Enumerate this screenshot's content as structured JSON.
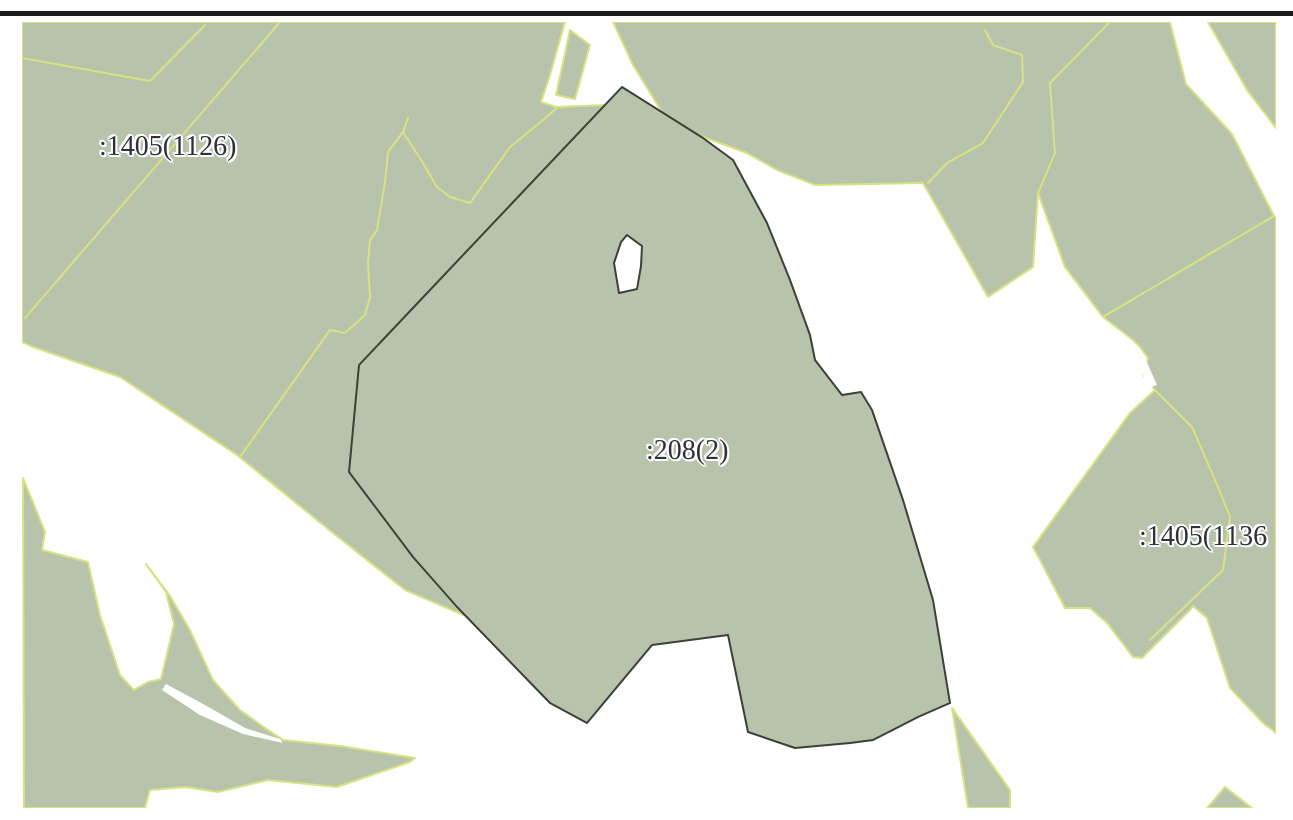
{
  "map": {
    "labels": [
      {
        "text": ":1405(1126)"
      },
      {
        "text": ":208(2)"
      },
      {
        "text": ":1405(1136"
      }
    ],
    "colors": {
      "parcel_fill": "#b8c3ac",
      "boundary_yellow": "#d9e282",
      "selected_outline": "#3c4038",
      "label_text": "#30303a",
      "label_halo": "#ffffff",
      "background": "#ffffff",
      "top_rule": "#1c1c1c"
    }
  }
}
